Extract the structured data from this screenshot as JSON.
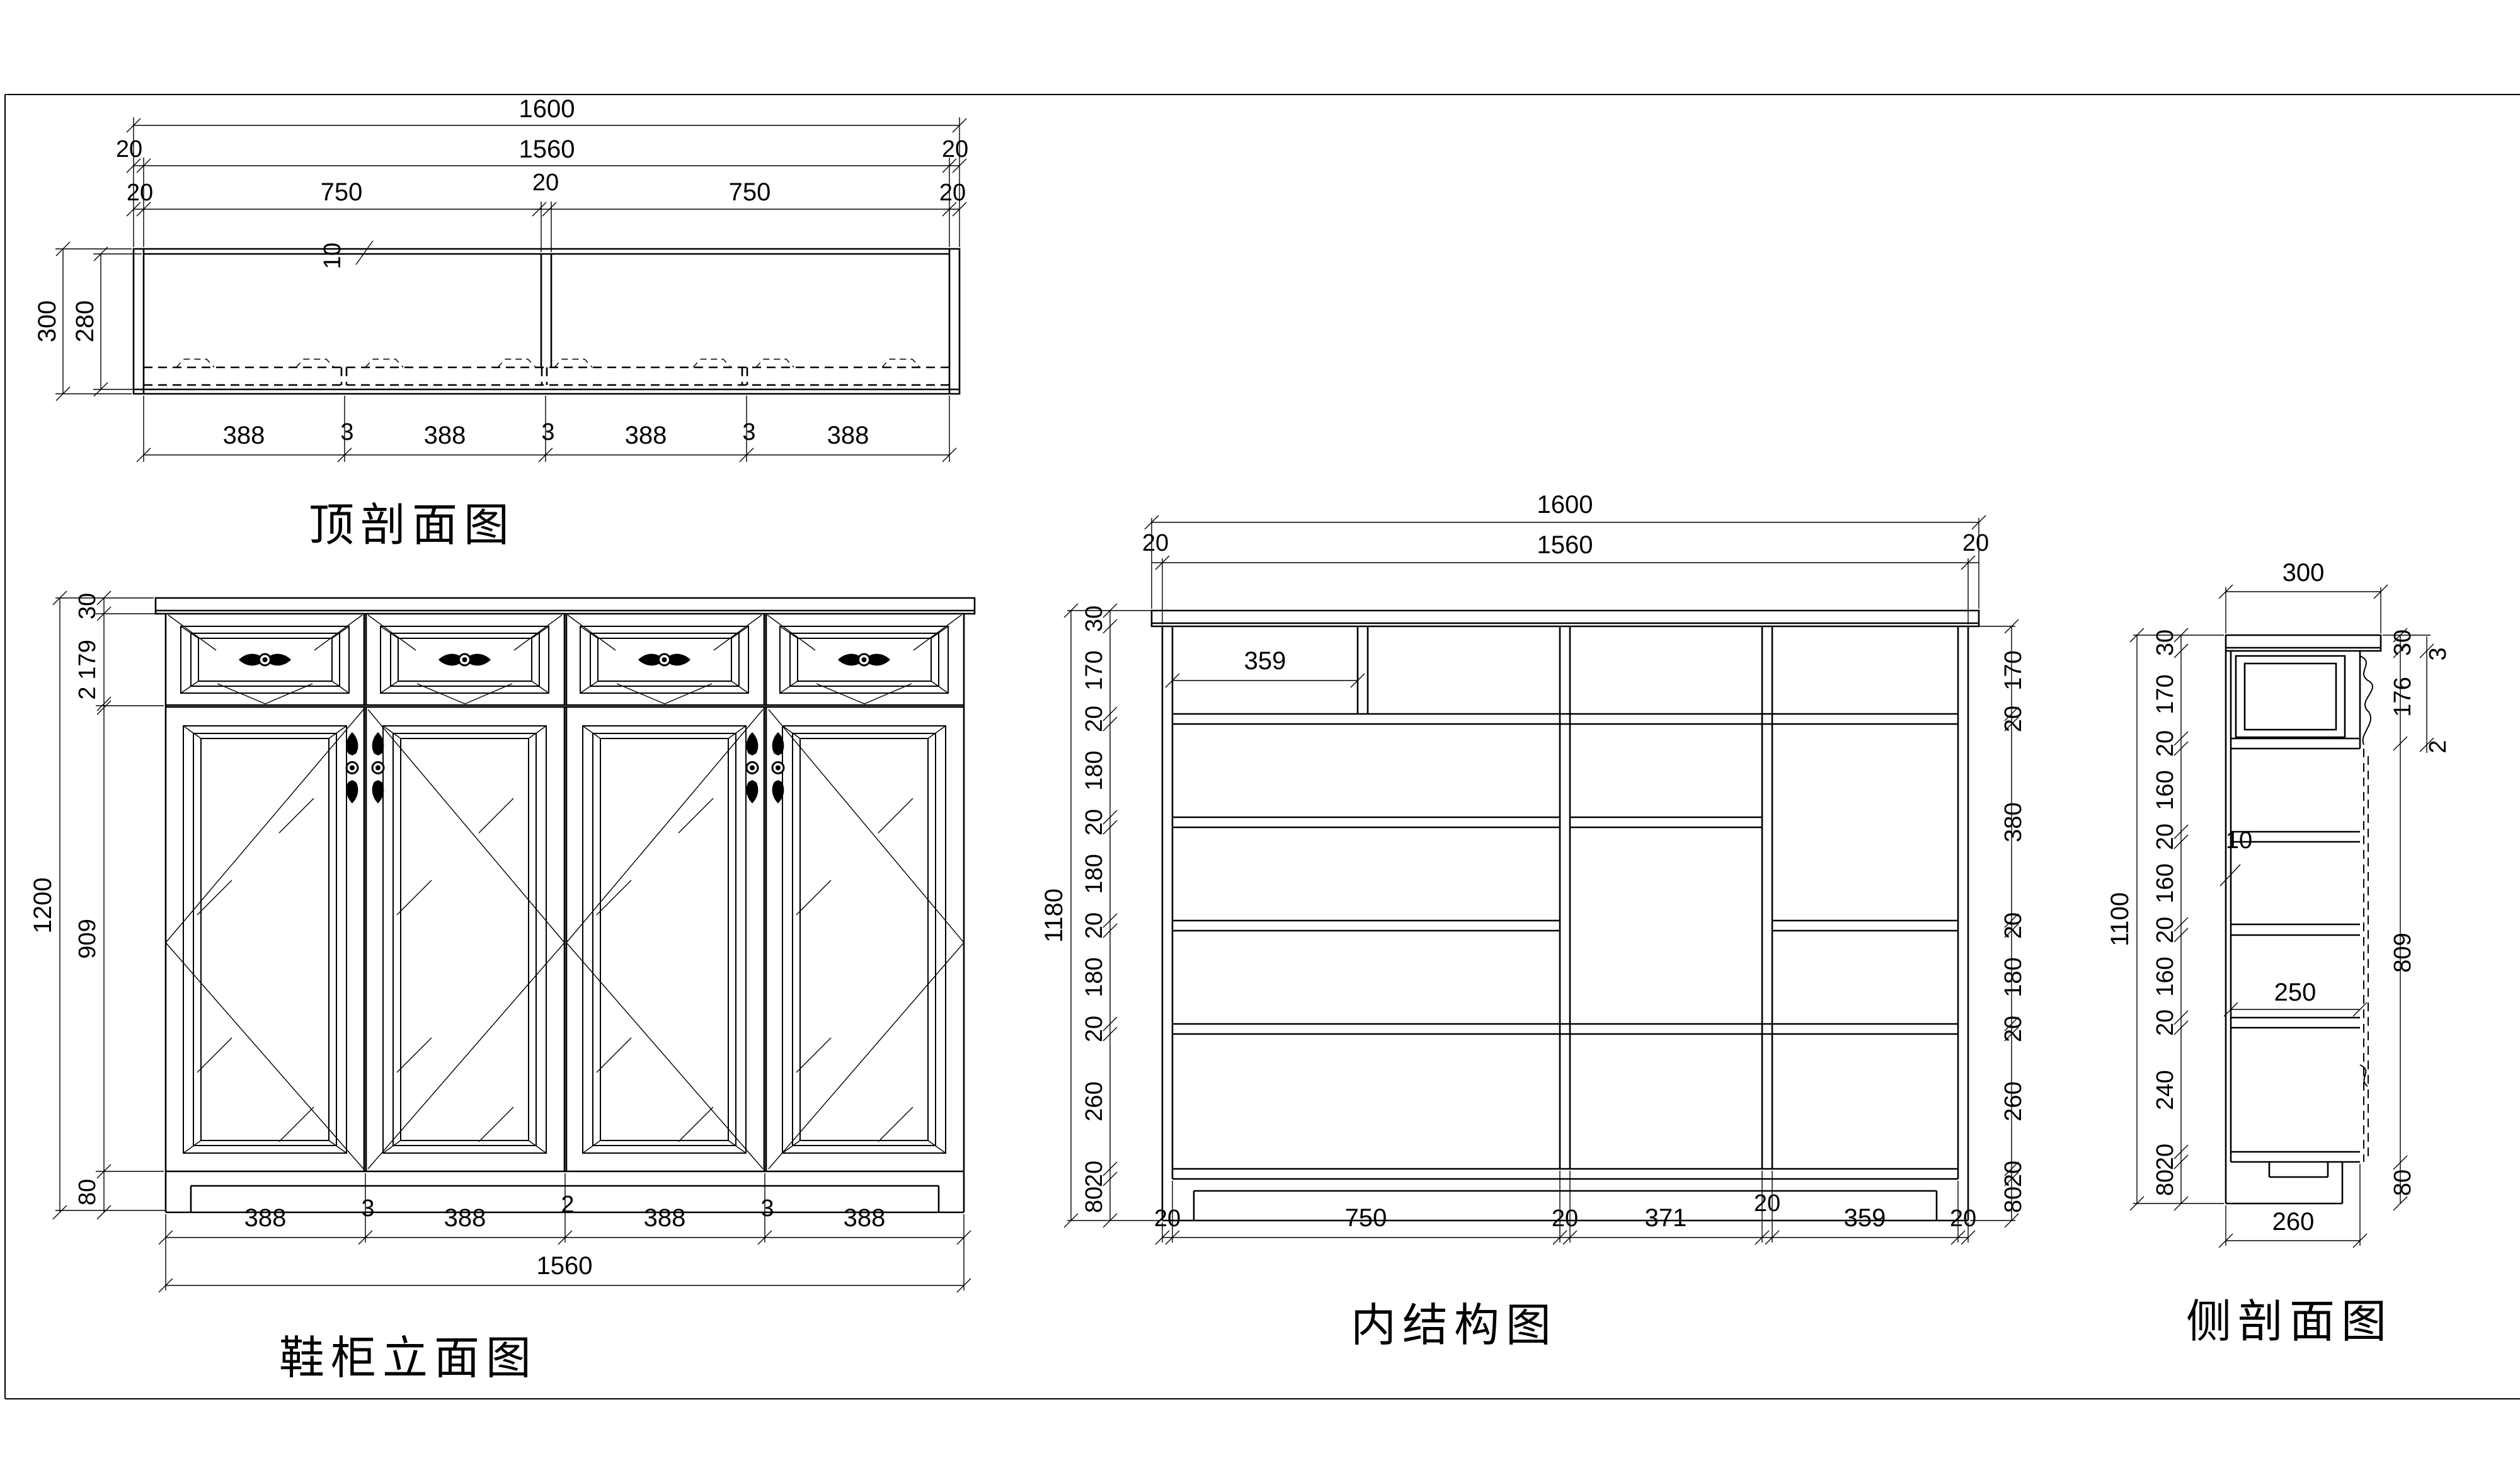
{
  "titles": {
    "top_section": "顶剖面图",
    "elevation": "鞋柜立面图",
    "internal": "内结构图",
    "side_section": "侧剖面图"
  },
  "top": {
    "w1600": "1600",
    "t20l": "20",
    "w1560": "1560",
    "t20r": "20",
    "row3": [
      "20",
      "750",
      "20",
      "750",
      "20"
    ],
    "back": "10",
    "d300": "300",
    "d280": "280",
    "bottom": [
      "388",
      "3",
      "388",
      "3",
      "388",
      "3",
      "388"
    ]
  },
  "elev": {
    "chain": [
      "30",
      "179",
      "2",
      "909",
      "80"
    ],
    "h1200": "1200",
    "bottom": [
      "388",
      "3",
      "388",
      "2",
      "388",
      "3",
      "388"
    ],
    "w1560": "1560"
  },
  "internal": {
    "w1600": "1600",
    "t20l": "20",
    "w1560": "1560",
    "t20r": "20",
    "chainL": [
      "30",
      "170",
      "20",
      "180",
      "20",
      "180",
      "20",
      "180",
      "20",
      "260",
      "20",
      "80"
    ],
    "h1180": "1180",
    "chainR": [
      "170",
      "20",
      "380",
      "20",
      "180",
      "20",
      "260",
      "20",
      "80"
    ],
    "cell359": "359",
    "bottom": [
      "20",
      "750",
      "20",
      "371",
      "20",
      "359",
      "20"
    ]
  },
  "side": {
    "d300": "300",
    "chainL": [
      "30",
      "170",
      "20",
      "160",
      "20",
      "160",
      "20",
      "160",
      "20",
      "240",
      "20",
      "80"
    ],
    "h1100": "1100",
    "chainR": [
      "30",
      "176",
      "809",
      "80"
    ],
    "g3": "3",
    "g2": "2",
    "back": "10",
    "shelf": "250",
    "d260": "260"
  }
}
